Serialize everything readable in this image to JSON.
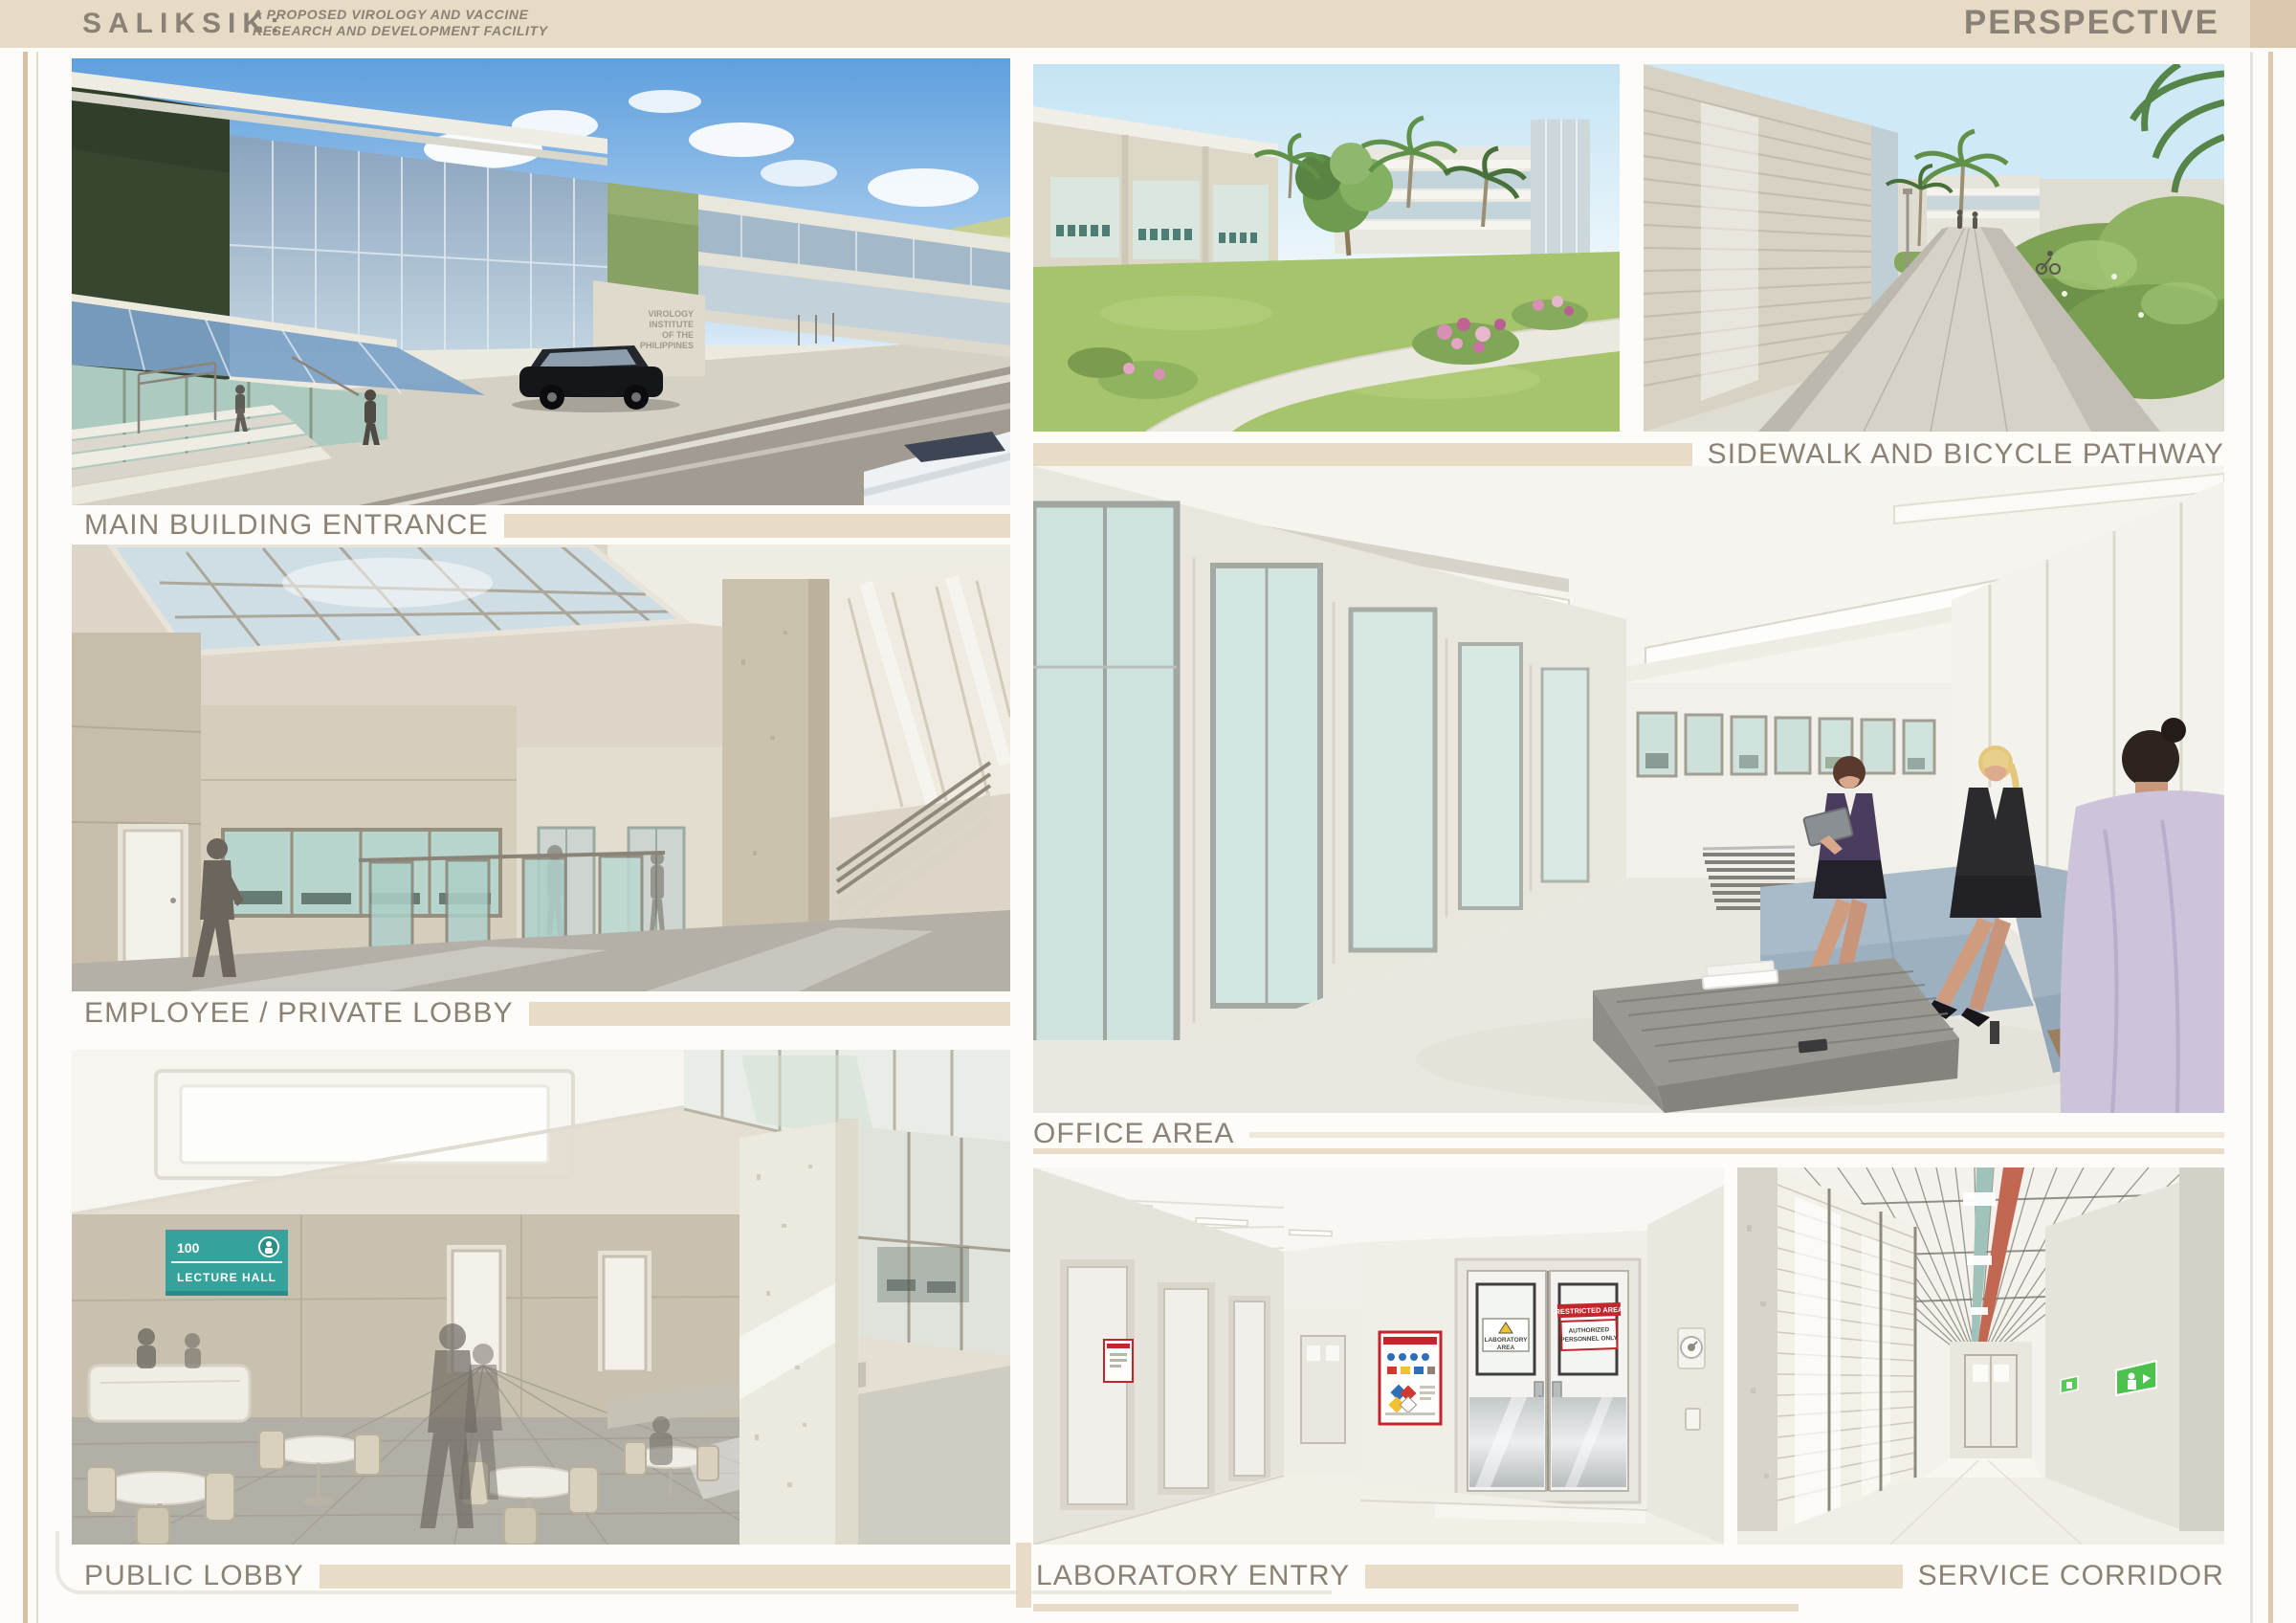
{
  "header": {
    "project_name": "SALIKSIK:",
    "subtitle": "A PROPOSED VIROLOGY AND VACCINE\nRESEARCH AND DEVELOPMENT FACILITY",
    "sheet_title": "PERSPECTIVE"
  },
  "panels": {
    "main_entrance": {
      "caption": "MAIN BUILDING ENTRANCE"
    },
    "employee_lobby": {
      "caption": "EMPLOYEE / PRIVATE LOBBY"
    },
    "public_lobby": {
      "caption": "PUBLIC LOBBY"
    },
    "sidewalk": {
      "caption": "SIDEWALK AND BICYCLE PATHWAY"
    },
    "office": {
      "caption": "OFFICE AREA"
    },
    "laboratory": {
      "caption": "LABORATORY ENTRY"
    },
    "service": {
      "caption": "SERVICE CORRIDOR"
    }
  },
  "render_labels": {
    "building_sign": {
      "l1": "VIROLOGY",
      "l2": "INSTITUTE",
      "l3": "OF THE",
      "l4": "PHILIPPINES"
    },
    "lecture_sign": {
      "number": "100",
      "label": "LECTURE HALL"
    },
    "lab_door": {
      "warning_line1": "LABORATORY",
      "warning_line2": "AREA",
      "restricted": "RESTRICTED AREA",
      "authorized_line1": "AUTHORIZED",
      "authorized_line2": "PERSONNEL ONLY",
      "push": "PUSH"
    }
  },
  "colors": {
    "header_bg": "#e7dbc5",
    "accent_bar": "#e8dcc6",
    "caption_text": "#8b8275",
    "restricted_red": "#c4242b",
    "sign_teal": "#35a39b"
  }
}
